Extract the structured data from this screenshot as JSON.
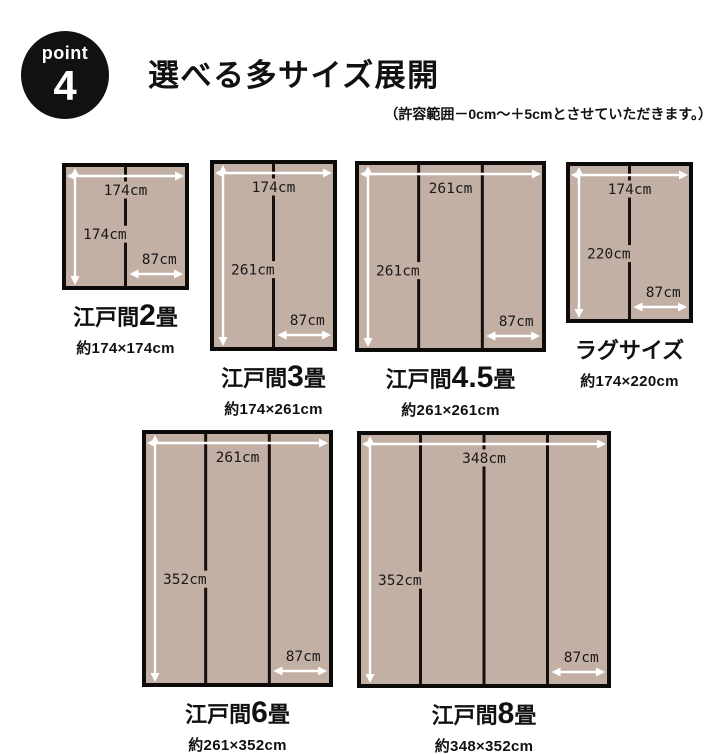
{
  "badge": {
    "label": "point",
    "number": "4"
  },
  "header": {
    "title": "選べる多サイズ展開",
    "note": "（許容範囲－0cm～＋5cmとさせていただきます。）"
  },
  "colors": {
    "mat_fill": "#c3b0a4",
    "mat_border": "#0d0b0a",
    "divider": "#16100d",
    "arrow": "#ffffff",
    "dim_text": "#1a1a1a",
    "badge_bg": "#111111",
    "badge_text": "#ffffff"
  },
  "diagrams": [
    {
      "id": "edoma-2jo",
      "name_prefix": "江戸間",
      "name_number": "2",
      "name_suffix": "畳",
      "approx": "約174×174cm",
      "width_cm": 174,
      "height_cm": 174,
      "panels": 2,
      "width_label": "174cm",
      "height_label": "174cm",
      "panel_width_label": "87cm"
    },
    {
      "id": "edoma-3jo",
      "name_prefix": "江戸間",
      "name_number": "3",
      "name_suffix": "畳",
      "approx": "約174×261cm",
      "width_cm": 174,
      "height_cm": 261,
      "panels": 2,
      "width_label": "174cm",
      "height_label": "261cm",
      "panel_width_label": "87cm"
    },
    {
      "id": "edoma-4-5jo",
      "name_prefix": "江戸間",
      "name_number": "4.5",
      "name_suffix": "畳",
      "approx": "約261×261cm",
      "width_cm": 261,
      "height_cm": 261,
      "panels": 3,
      "width_label": "261cm",
      "height_label": "261cm",
      "panel_width_label": "87cm"
    },
    {
      "id": "rug-size",
      "name_prefix": "ラグサイズ",
      "name_number": "",
      "name_suffix": "",
      "approx": "約174×220cm",
      "width_cm": 174,
      "height_cm": 220,
      "panels": 2,
      "width_label": "174cm",
      "height_label": "220cm",
      "panel_width_label": "87cm"
    },
    {
      "id": "edoma-6jo",
      "name_prefix": "江戸間",
      "name_number": "6",
      "name_suffix": "畳",
      "approx": "約261×352cm",
      "width_cm": 261,
      "height_cm": 352,
      "panels": 3,
      "width_label": "261cm",
      "height_label": "352cm",
      "panel_width_label": "87cm"
    },
    {
      "id": "edoma-8jo",
      "name_prefix": "江戸間",
      "name_number": "8",
      "name_suffix": "畳",
      "approx": "約348×352cm",
      "width_cm": 348,
      "height_cm": 352,
      "panels": 4,
      "width_label": "348cm",
      "height_label": "352cm",
      "panel_width_label": "87cm"
    }
  ]
}
